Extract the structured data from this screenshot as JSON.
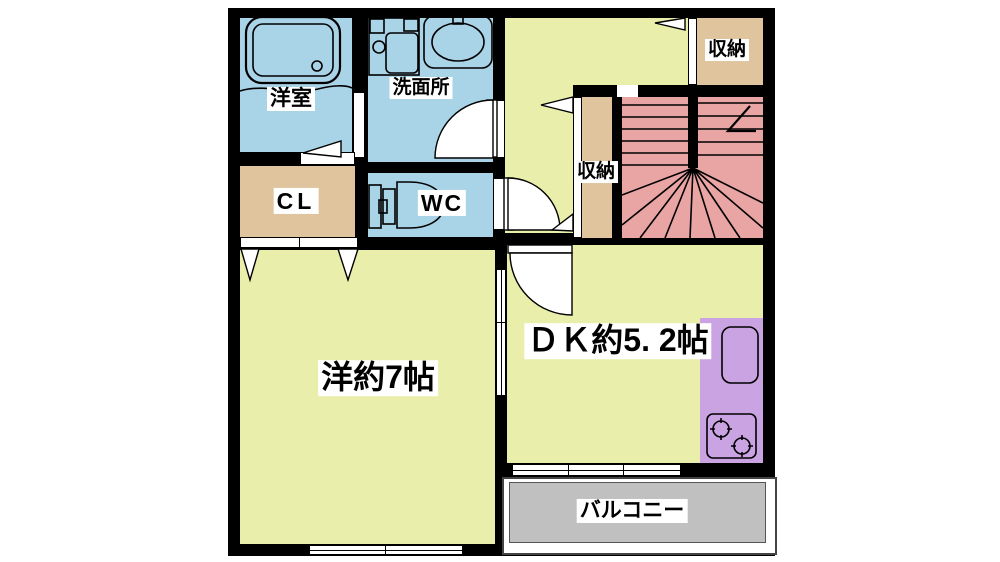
{
  "plan_title": "1R floor plan",
  "rooms": [
    {
      "id": "bath",
      "label": "洋室"
    },
    {
      "id": "washroom",
      "label": "洗面所"
    },
    {
      "id": "storage_top",
      "label": "収納"
    },
    {
      "id": "closet",
      "label": "CL"
    },
    {
      "id": "wc",
      "label": "WC"
    },
    {
      "id": "storage_hall",
      "label": "収納"
    },
    {
      "id": "western_room",
      "label": "洋約7帖"
    },
    {
      "id": "dining_kitchen",
      "label": "ＤＫ約5. 2帖"
    },
    {
      "id": "balcony",
      "label": "バルコニー"
    }
  ],
  "colors": {
    "wall": "#000000",
    "background": "#ffffff",
    "wet_area": "#a9d3e7",
    "room": "#eaeeab",
    "storage": "#dfc49e",
    "stairs": "#e9a4a4",
    "kitchen": "#c9a3e2",
    "balcony": "#c0c0c0",
    "balcony_border": "#444444",
    "label_bg": "#ffffff",
    "label_text": "#000000"
  }
}
